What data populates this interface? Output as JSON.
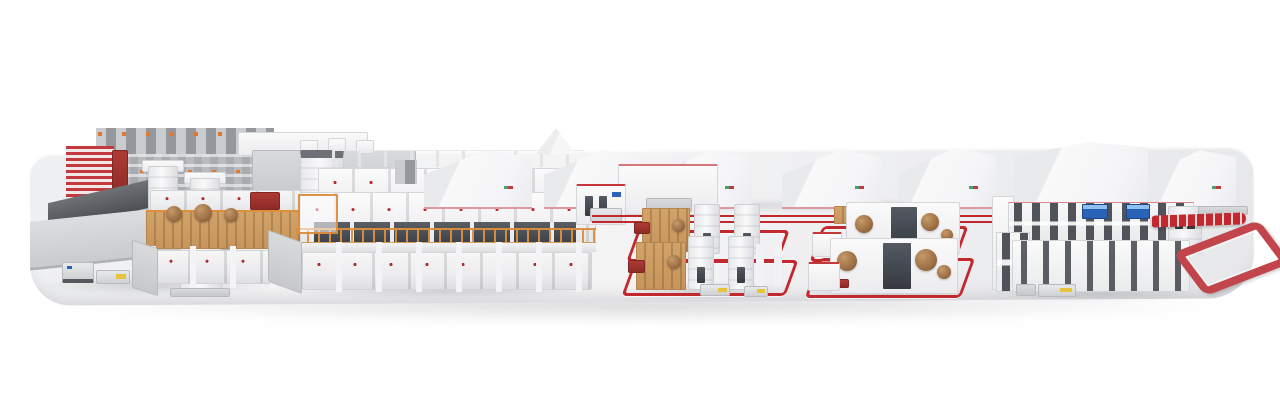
{
  "palette": {
    "background": "#ffffff",
    "platform_top": "#f4f4f5",
    "accent_red": "#c0272e",
    "rail_red": "#c2292f",
    "railing_orange": "#dd8f3c",
    "scaffold_tan": "#c6945c",
    "roll_brown": "#96693f",
    "screen_blue": "#2a62b8",
    "panel_dark": "#3c4046",
    "rack_gray": "#a8abaf"
  },
  "scene": {
    "components": [
      "display-platform",
      "high-bay-roll-storage",
      "red-storage-rack",
      "infeed-conveyor-ramp",
      "roll-handling-table",
      "roll-transport-agv",
      "roll-preparation-scaffold",
      "corrugator-wet-end",
      "mezzanine-platform",
      "operator-stairs",
      "control-cabinets",
      "floor-rail-track",
      "roll-stand-group-1",
      "roll-stand-group-2",
      "paper-rolls",
      "splicer-towers",
      "dry-end-line",
      "dry-end-displays",
      "overhead-conveyor",
      "elevated-conveyor-loop",
      "background-machine-halls"
    ]
  }
}
